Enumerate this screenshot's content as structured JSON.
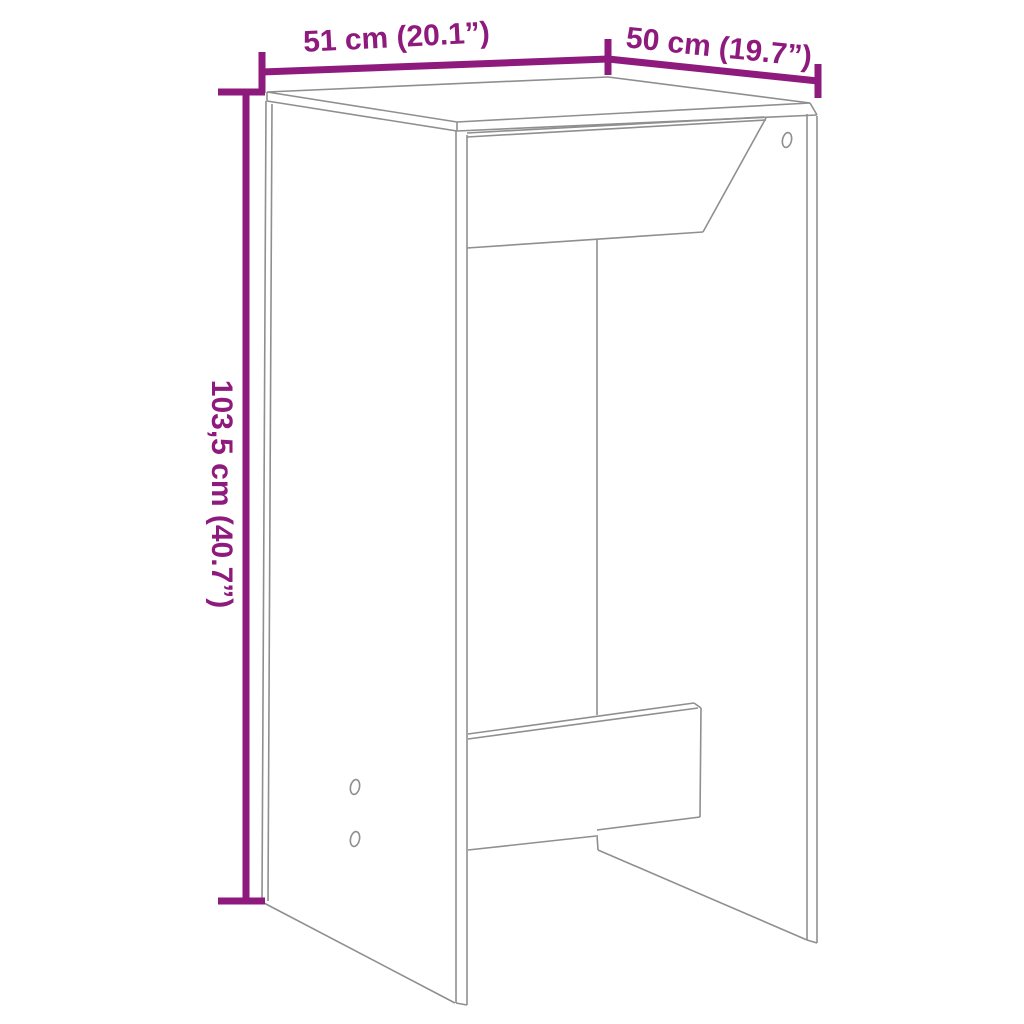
{
  "page": {
    "background_color": "#ffffff",
    "description": "Technical dimension diagram of a bar table (line drawing, no UI chrome)"
  },
  "diagram": {
    "kind": "furniture-dimension-diagram",
    "subject": "bar table with side panels, center panel and footrest",
    "colors": {
      "outline": "#8f8f8f",
      "dimension": "#8E1A7D",
      "background": "#ffffff"
    },
    "stroke": {
      "outline_width": 1.6,
      "dimension_width": 7
    },
    "labels": [
      {
        "id": "width-label",
        "text": "51 cm (20.1”)"
      },
      {
        "id": "depth-label",
        "text": "50 cm (19.7”)"
      },
      {
        "id": "height-label",
        "text": "103,5 cm (40.7”)"
      }
    ],
    "dimensions_cm": {
      "width": "51",
      "depth": "50",
      "height": "103,5"
    },
    "dimensions_in": {
      "width": "20.1",
      "depth": "19.7",
      "height": "40.7"
    },
    "outline_segments": [
      [
        267,
        92,
        608,
        77
      ],
      [
        608,
        77,
        810,
        103
      ],
      [
        267,
        92,
        457,
        122
      ],
      [
        457,
        122,
        810,
        103
      ],
      [
        267,
        92,
        267,
        101
      ],
      [
        267,
        101,
        457,
        131
      ],
      [
        457,
        122,
        457,
        131
      ],
      [
        457,
        131,
        817,
        115
      ],
      [
        810,
        103,
        817,
        115
      ],
      [
        266,
        101,
        262,
        901
      ],
      [
        272,
        104,
        268,
        901
      ],
      [
        264,
        903,
        455,
        1003
      ],
      [
        456,
        131,
        456,
        1003
      ],
      [
        467,
        135,
        467,
        1005
      ],
      [
        456,
        1003,
        467,
        1005
      ],
      [
        467,
        133,
        764,
        117
      ],
      [
        467,
        137,
        766,
        120
      ],
      [
        766,
        118,
        703,
        232
      ],
      [
        467,
        248,
        703,
        232
      ],
      [
        597,
        239,
        597,
        715
      ],
      [
        597,
        835,
        598,
        850
      ],
      [
        598,
        850,
        807,
        940
      ],
      [
        807,
        114,
        807,
        940
      ],
      [
        817,
        116,
        817,
        943
      ],
      [
        807,
        940,
        817,
        943
      ],
      [
        468,
        734,
        694,
        703
      ],
      [
        468,
        739,
        698,
        708
      ],
      [
        694,
        703,
        701,
        708
      ],
      [
        701,
        708,
        700,
        817
      ],
      [
        700,
        817,
        597,
        830
      ],
      [
        596,
        836,
        468,
        850
      ]
    ],
    "dimension_segments": [
      [
        246,
        92,
        246,
        901
      ],
      [
        218,
        92,
        265,
        92
      ],
      [
        218,
        901,
        265,
        901
      ],
      [
        262,
        72,
        608,
        59
      ],
      [
        262,
        52,
        262,
        93
      ],
      [
        608,
        39,
        608,
        75
      ],
      [
        608,
        59,
        818,
        81
      ],
      [
        818,
        64,
        818,
        98
      ]
    ],
    "holes": [
      {
        "cx": 787,
        "cy": 140,
        "rx": 4.5,
        "ry": 7.5,
        "rot": 12
      },
      {
        "cx": 355,
        "cy": 787,
        "rx": 4.5,
        "ry": 7.5,
        "rot": 12
      },
      {
        "cx": 355,
        "cy": 839,
        "rx": 4.5,
        "ry": 7.5,
        "rot": 12
      }
    ]
  }
}
